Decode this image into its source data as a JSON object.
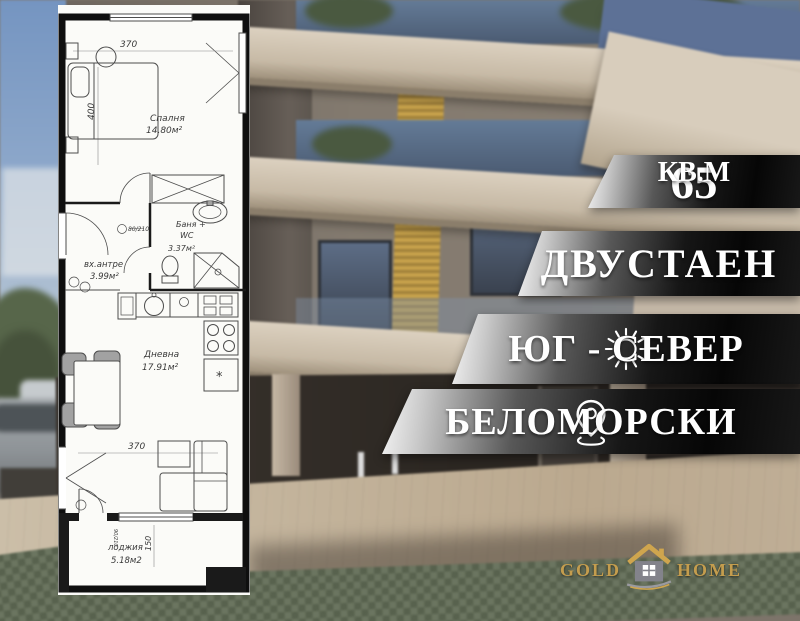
{
  "banners": [
    {
      "value": "65",
      "unit": "КВ.М"
    },
    {
      "label": "ДВУСТАЕН"
    },
    {
      "label": "ЮГ - СЕВЕР",
      "icon": "sun"
    },
    {
      "label": "БЕЛОМОРСКИ",
      "icon": "location-pin"
    }
  ],
  "logo": {
    "word_left": "GOLD",
    "word_right": "HOME",
    "icon": "house"
  },
  "floor_plan": {
    "rooms": {
      "bedroom": {
        "name": "Спалня",
        "area": "14.80м²"
      },
      "bath": {
        "line1": "Баня +",
        "line2": "WC",
        "area": "3.37м²"
      },
      "entry": {
        "name": "вх.антре",
        "area": "3.99м²"
      },
      "living": {
        "name": "Дневна",
        "area": "17.91м²"
      },
      "loggia": {
        "name": "лоджия",
        "area": "5.18м2"
      }
    },
    "dims": {
      "top_width": "370",
      "bedroom_depth": "400",
      "living_width": "370",
      "loggia_depth": "150",
      "bath_door": "80/210",
      "loggia_door": "90/210",
      "fridge_mark": "*"
    }
  },
  "colors": {
    "gold": "#c49d4e",
    "banner_text": "#ffffff",
    "banner_light": "#f7f7f7",
    "banner_dark": "#0a0a0a",
    "facade_beige": "#d0c4b2",
    "accent_yellow": "#c7a24b"
  }
}
